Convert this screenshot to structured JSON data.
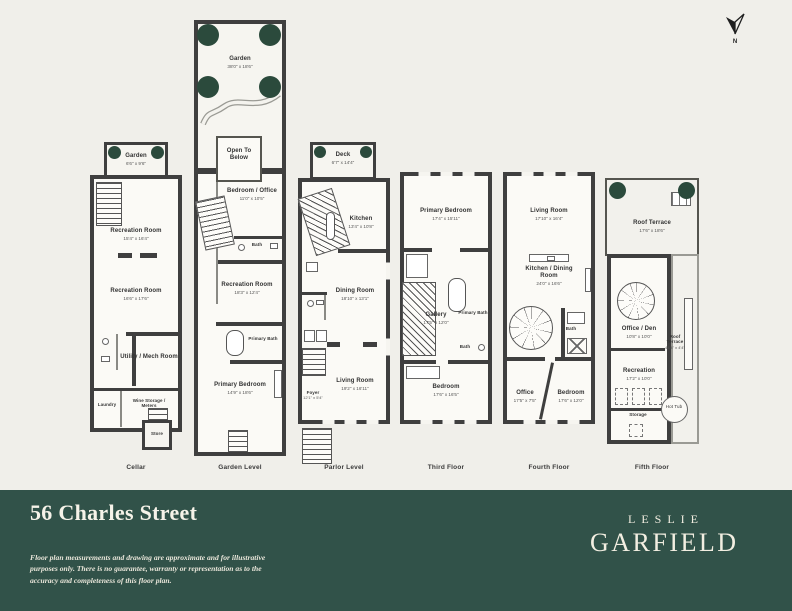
{
  "compass": {
    "label": "N"
  },
  "floors": [
    {
      "label": "Cellar",
      "rooms": [
        {
          "name": "Garden",
          "dims": "6'6\" x 9'6\""
        },
        {
          "name": "Recreation Room",
          "dims": "15'4\" x 16'4\""
        },
        {
          "name": "Recreation Room",
          "dims": "16'6\" x 17'6\""
        },
        {
          "name": "Utility / Mech Room",
          "dims": ""
        },
        {
          "name": "Laundry",
          "dims": ""
        },
        {
          "name": "Wine Storage / Meters",
          "dims": ""
        },
        {
          "name": "Store",
          "dims": ""
        }
      ]
    },
    {
      "label": "Garden Level",
      "rooms": [
        {
          "name": "Garden",
          "dims": "38'0\" x 18'6\""
        },
        {
          "name": "Open To Below",
          "dims": ""
        },
        {
          "name": "Bedroom / Office",
          "dims": "11'0\" x 10'5\""
        },
        {
          "name": "Bath",
          "dims": ""
        },
        {
          "name": "Recreation Room",
          "dims": "18'3\" x 12'4\""
        },
        {
          "name": "Primary Bath",
          "dims": ""
        },
        {
          "name": "Primary Bedroom",
          "dims": "14'9\" x 18'6\""
        }
      ]
    },
    {
      "label": "Parlor Level",
      "rooms": [
        {
          "name": "Deck",
          "dims": "6'7\" x 14'4\""
        },
        {
          "name": "Kitchen",
          "dims": "13'4\" x 10'8\""
        },
        {
          "name": "Dining Room",
          "dims": "18'10\" x 13'1\""
        },
        {
          "name": "Foyer",
          "dims": "12'1\" x 5'4\""
        },
        {
          "name": "Living Room",
          "dims": "19'2\" x 16'11\""
        }
      ]
    },
    {
      "label": "Third Floor",
      "rooms": [
        {
          "name": "Primary Bedroom",
          "dims": "17'4\" x 15'11\""
        },
        {
          "name": "Gallery",
          "dims": "17'5\" x 12'0\""
        },
        {
          "name": "Primary Bath",
          "dims": ""
        },
        {
          "name": "Bath",
          "dims": ""
        },
        {
          "name": "Bedroom",
          "dims": "17'6\" x 16'5\""
        }
      ]
    },
    {
      "label": "Fourth Floor",
      "rooms": [
        {
          "name": "Living Room",
          "dims": "17'10\" x 16'4\""
        },
        {
          "name": "Kitchen / Dining Room",
          "dims": "24'0\" x 16'6\""
        },
        {
          "name": "Office",
          "dims": "17'5\" x 7'5\""
        },
        {
          "name": "Bedroom",
          "dims": "17'6\" x 12'0\""
        },
        {
          "name": "Bath",
          "dims": ""
        }
      ]
    },
    {
      "label": "Fifth Floor",
      "rooms": [
        {
          "name": "Roof Terrace",
          "dims": "17'6\" x 18'6\""
        },
        {
          "name": "Office / Den",
          "dims": "10'8\" x 10'0\""
        },
        {
          "name": "Recreation",
          "dims": "17'2\" x 10'0\""
        },
        {
          "name": "Storage",
          "dims": ""
        },
        {
          "name": "Roof Terrace",
          "dims": "44'4\" x 4'4\""
        },
        {
          "name": "Hot Tub",
          "dims": ""
        }
      ]
    }
  ],
  "footer": {
    "address": "56 Charles Street",
    "disclaimer": "Floor plan measurements and drawing are approximate and for illustrative purposes only. There is no guarantee, warranty or representation as to the accuracy and completeness of this floor plan.",
    "brand_line1": "LESLIE",
    "brand_line2": "GARFIELD"
  },
  "colors": {
    "page_bg": "#f0efea",
    "band_bg": "#315249",
    "wall": "#3f3f3f",
    "tree_green": "#2b4a3c",
    "cream": "#f2eee1"
  }
}
